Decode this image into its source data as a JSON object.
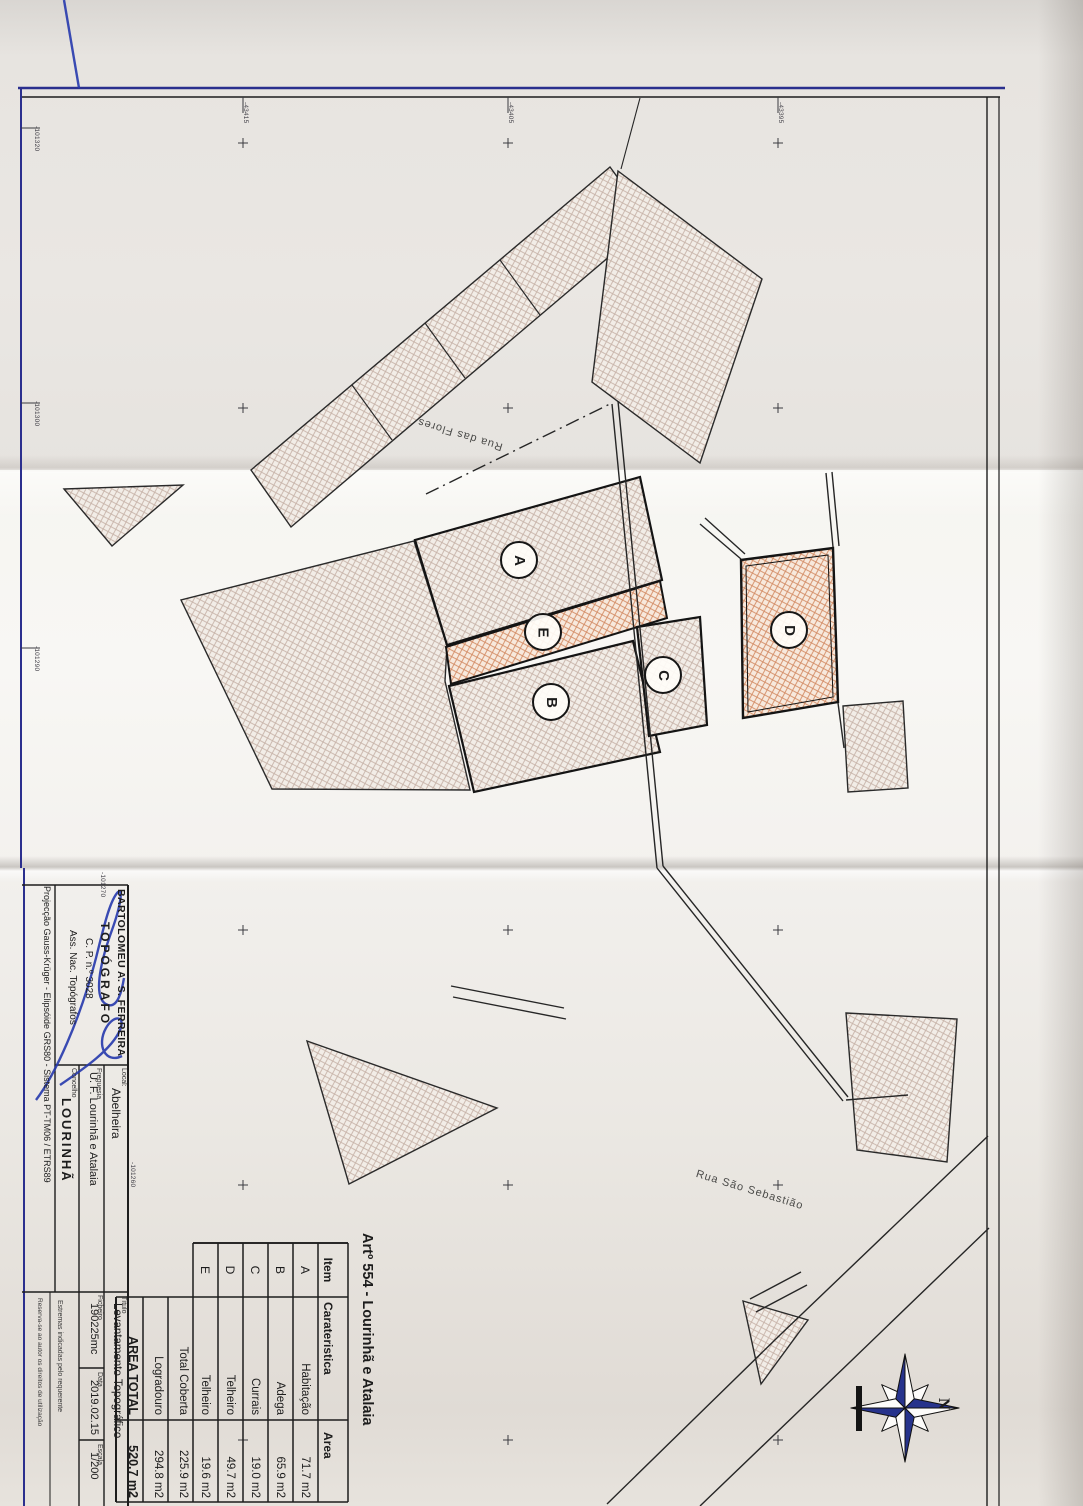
{
  "sheet": {
    "coordinate_labels_bottom_edge": [
      "-101320",
      "-101300",
      "-101290",
      "-101270",
      "-101260"
    ],
    "coordinate_labels_left_edge": [
      "-43415",
      "-43405",
      "-43395"
    ]
  },
  "map": {
    "streets": [
      {
        "name": "Rua das Flores"
      },
      {
        "name": "Rua São Sebastião"
      }
    ],
    "buildings": [
      {
        "id": "A"
      },
      {
        "id": "B"
      },
      {
        "id": "C"
      },
      {
        "id": "D"
      },
      {
        "id": "E"
      }
    ],
    "north_label": "N"
  },
  "area_table": {
    "title": "Artº 554 - Lourinhã e Atalaia",
    "headers": {
      "item": "Item",
      "feature": "Carateristica",
      "area": "Area"
    },
    "rows": [
      {
        "item": "A",
        "feature": "Habitação",
        "area": "71.7 m2"
      },
      {
        "item": "B",
        "feature": "Adega",
        "area": "65.9 m2"
      },
      {
        "item": "C",
        "feature": "Currais",
        "area": "19.0 m2"
      },
      {
        "item": "D",
        "feature": "Telheiro",
        "area": "49.7 m2"
      },
      {
        "item": "E",
        "feature": "Telheiro",
        "area": "19.6 m2"
      }
    ],
    "totals": [
      {
        "label": "Total Coberta",
        "area": "225.9 m2"
      },
      {
        "label": "Logradouro",
        "area": "294.8 m2"
      },
      {
        "label": "AREA TOTAL",
        "area": "520.7 m2"
      }
    ]
  },
  "title_block": {
    "surveyor_name": "BARTOLOMEU A. S. FERREIRA",
    "surveyor_title": "TOPÓGRAFO",
    "surveyor_license": "C. P. n.º 3028",
    "surveyor_assoc": "Ass. Nac. Topógrafos",
    "projection_note": "Projecção Gauss-Krüger - Elipsóide GRS80 - Sistema PT-TM06 / ETRS89",
    "local_label": "Local:",
    "local_value": "Abelheira",
    "freguesia_label": "Freguesia",
    "freguesia_value": "U. F. Lourinhã e Atalaia",
    "concelho_label": "Concelho",
    "concelho_value": "LOURINHÃ",
    "titulo_label": "Título",
    "titulo_value": "Levantamento Topográfico",
    "ficheiro_label": "Ficheiro",
    "ficheiro_value": "190225mc",
    "data_label": "Data",
    "data_value": "2019.02.15",
    "escala_label": "Escala",
    "escala_value": "1/200",
    "note_1": "Estremas indicadas pelo requerente",
    "note_2": "Reserva-se ao autor os direitos de utilização"
  },
  "colors": {
    "border_navy": "#2b2f8e",
    "signature_blue": "#2639ad",
    "hatch_gray_line": "#bfa89c",
    "hatch_orange_line": "#cf8055",
    "compass_navy": "#27338c"
  }
}
